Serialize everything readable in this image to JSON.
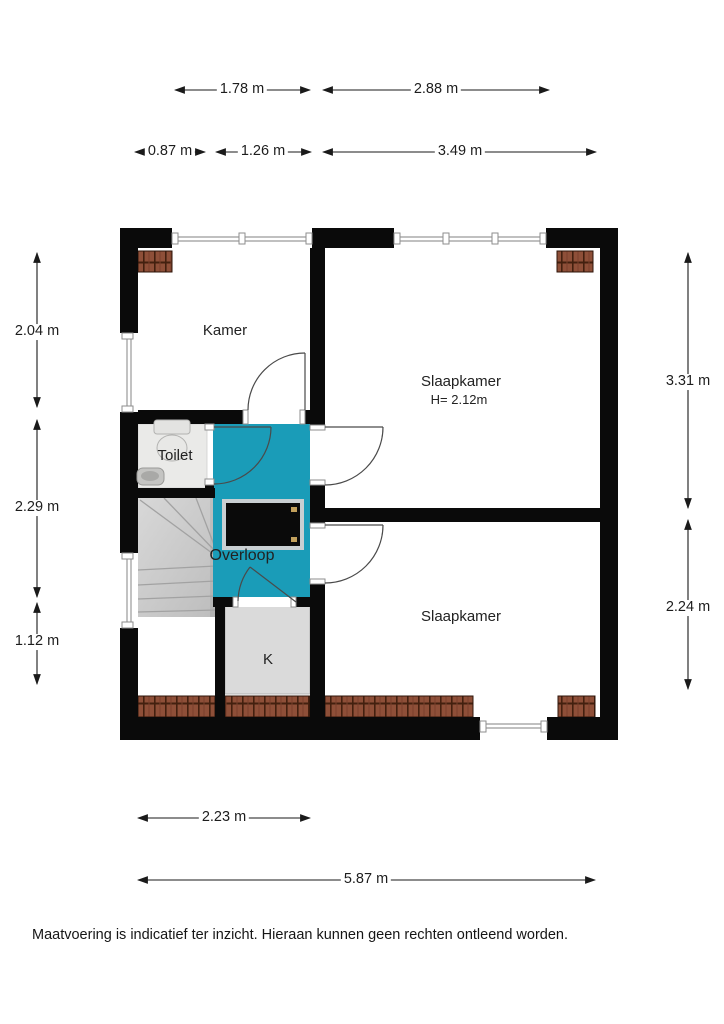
{
  "plan": {
    "rooms": {
      "kamer": "Kamer",
      "slaapkamer_1": "Slaapkamer",
      "slaapkamer_1_height": "H= 2.12m",
      "toilet": "Toilet",
      "overloop": "Overloop",
      "kast": "K",
      "slaapkamer_2": "Slaapkamer"
    },
    "colors": {
      "wall": "#0a0a0a",
      "landing_highlight": "#1a9cb8",
      "roof_tiles": "#8e4f38",
      "roof_tiles_dark": "#43200f",
      "stairs_floor": "#cccccc",
      "closet_floor": "#dadada",
      "toilet_floor": "#eaeae8"
    }
  },
  "dimensions": {
    "top_row_1": {
      "seg_1": "1.78 m",
      "seg_2": "2.88 m"
    },
    "top_row_2": {
      "seg_1": "0.87 m",
      "seg_2": "1.26 m",
      "seg_3": "3.49 m"
    },
    "left": {
      "seg_1": "2.04 m",
      "seg_2": "2.29 m",
      "seg_3": "1.12 m"
    },
    "right": {
      "seg_1": "3.31 m",
      "seg_2": "2.24 m"
    },
    "bottom": {
      "seg_1": "2.23 m",
      "seg_2": "5.87 m"
    }
  },
  "footer": {
    "disclaimer": "Maatvoering is indicatief ter inzicht. Hieraan kunnen geen rechten ontleend worden."
  }
}
